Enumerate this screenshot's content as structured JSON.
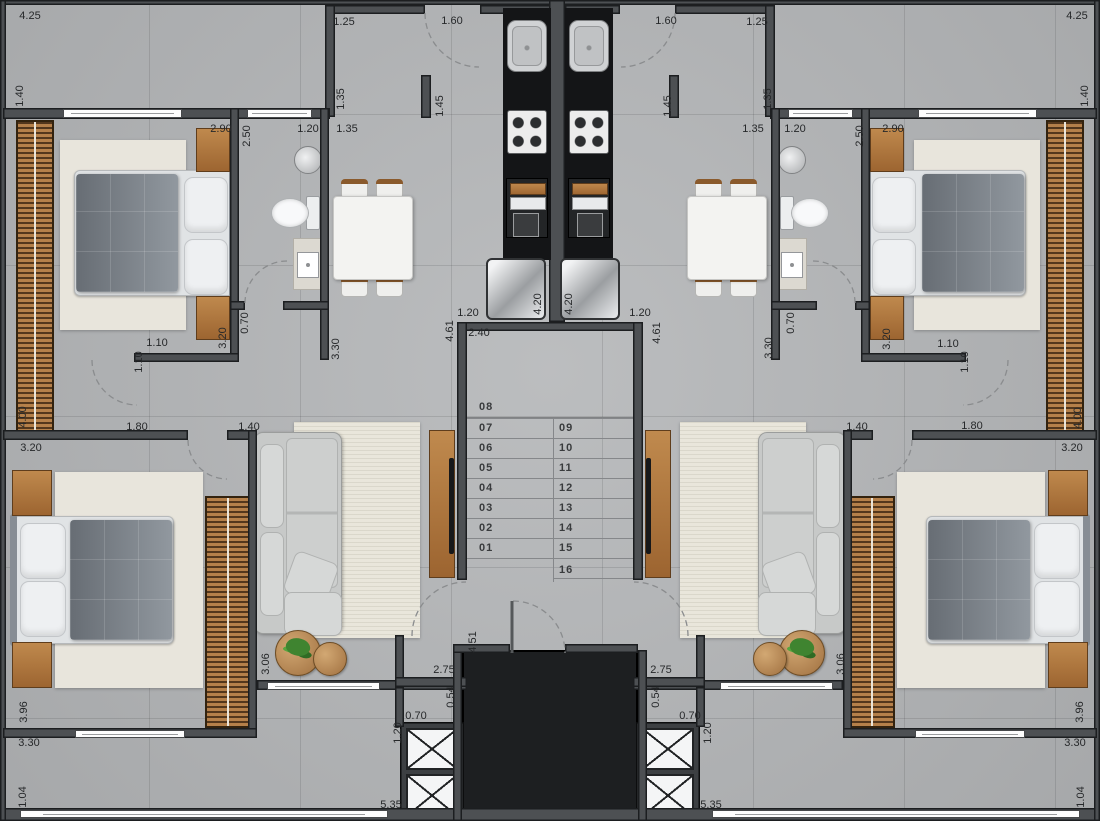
{
  "plan": {
    "type": "residential floor plan - typical storey, two mirrored apartments around central stair and elevator core",
    "stairs": {
      "left_flight": [
        "01",
        "02",
        "03",
        "04",
        "05",
        "06",
        "07",
        "08"
      ],
      "right_flight": [
        "09",
        "10",
        "11",
        "12",
        "13",
        "14",
        "15",
        "16"
      ]
    }
  },
  "colors": {
    "floor": "#b4b6b8",
    "wall": "#4d5053",
    "wallline": "#1c1e20",
    "counter": "#141517",
    "voidfill": "#1d1f21",
    "wood": "#b5804a",
    "woodd": "#8a5a2c",
    "label": "#26282a",
    "windowc": "#fdfdfd",
    "green": "#3f8430"
  },
  "dimension_labels": [
    {
      "t": "4.25",
      "x": 30,
      "y": 16,
      "o": "h"
    },
    {
      "t": "1.40",
      "x": 20,
      "y": 96,
      "o": "v"
    },
    {
      "t": "1.25",
      "x": 344,
      "y": 22,
      "o": "h"
    },
    {
      "t": "1.60",
      "x": 452,
      "y": 21,
      "o": "h"
    },
    {
      "t": "1.60",
      "x": 666,
      "y": 21,
      "o": "h"
    },
    {
      "t": "1.25",
      "x": 757,
      "y": 22,
      "o": "h"
    },
    {
      "t": "4.25",
      "x": 1077,
      "y": 16,
      "o": "h"
    },
    {
      "t": "1.40",
      "x": 1085,
      "y": 96,
      "o": "v"
    },
    {
      "t": "1.35",
      "x": 341,
      "y": 99,
      "o": "v"
    },
    {
      "t": "1.45",
      "x": 440,
      "y": 106,
      "o": "v"
    },
    {
      "t": "1.45",
      "x": 668,
      "y": 106,
      "o": "v"
    },
    {
      "t": "1.35",
      "x": 768,
      "y": 99,
      "o": "v"
    },
    {
      "t": "2.90",
      "x": 221,
      "y": 129,
      "o": "h"
    },
    {
      "t": "2.50",
      "x": 247,
      "y": 136,
      "o": "v"
    },
    {
      "t": "1.20",
      "x": 308,
      "y": 129,
      "o": "h"
    },
    {
      "t": "1.35",
      "x": 347,
      "y": 129,
      "o": "h"
    },
    {
      "t": "1.35",
      "x": 753,
      "y": 129,
      "o": "h"
    },
    {
      "t": "1.20",
      "x": 795,
      "y": 129,
      "o": "h"
    },
    {
      "t": "2.50",
      "x": 860,
      "y": 136,
      "o": "v"
    },
    {
      "t": "2.90",
      "x": 893,
      "y": 129,
      "o": "h"
    },
    {
      "t": "0.70",
      "x": 245,
      "y": 323,
      "o": "v"
    },
    {
      "t": "3.20",
      "x": 223,
      "y": 338,
      "o": "v"
    },
    {
      "t": "3.30",
      "x": 336,
      "y": 349,
      "o": "v"
    },
    {
      "t": "1.10",
      "x": 157,
      "y": 343,
      "o": "h"
    },
    {
      "t": "1.10",
      "x": 139,
      "y": 362,
      "o": "v"
    },
    {
      "t": "0.70",
      "x": 791,
      "y": 323,
      "o": "v"
    },
    {
      "t": "3.20",
      "x": 887,
      "y": 339,
      "o": "v"
    },
    {
      "t": "3.30",
      "x": 769,
      "y": 348,
      "o": "v"
    },
    {
      "t": "1.10",
      "x": 948,
      "y": 344,
      "o": "h"
    },
    {
      "t": "1.10",
      "x": 965,
      "y": 362,
      "o": "v"
    },
    {
      "t": "1.20",
      "x": 468,
      "y": 313,
      "o": "h"
    },
    {
      "t": "4.20",
      "x": 538,
      "y": 304,
      "o": "v"
    },
    {
      "t": "4.20",
      "x": 569,
      "y": 304,
      "o": "v"
    },
    {
      "t": "1.20",
      "x": 640,
      "y": 313,
      "o": "h"
    },
    {
      "t": "4.61",
      "x": 450,
      "y": 331,
      "o": "v"
    },
    {
      "t": "2.40",
      "x": 479,
      "y": 333,
      "o": "h"
    },
    {
      "t": "4.61",
      "x": 657,
      "y": 333,
      "o": "v"
    },
    {
      "t": "1.80",
      "x": 137,
      "y": 427,
      "o": "h"
    },
    {
      "t": "1.40",
      "x": 249,
      "y": 427,
      "o": "h"
    },
    {
      "t": "3.20",
      "x": 31,
      "y": 448,
      "o": "h"
    },
    {
      "t": "4.00",
      "x": 23,
      "y": 417,
      "o": "v"
    },
    {
      "t": "1.80",
      "x": 972,
      "y": 426,
      "o": "h"
    },
    {
      "t": "1.40",
      "x": 857,
      "y": 427,
      "o": "h"
    },
    {
      "t": "3.20",
      "x": 1072,
      "y": 448,
      "o": "h"
    },
    {
      "t": "4.00",
      "x": 1078,
      "y": 418,
      "o": "v"
    },
    {
      "t": "3.06",
      "x": 266,
      "y": 664,
      "o": "v"
    },
    {
      "t": "4.51",
      "x": 473,
      "y": 642,
      "o": "v"
    },
    {
      "t": "2.75",
      "x": 444,
      "y": 670,
      "o": "h"
    },
    {
      "t": "2.75",
      "x": 661,
      "y": 670,
      "o": "h"
    },
    {
      "t": "3.06",
      "x": 841,
      "y": 664,
      "o": "v"
    },
    {
      "t": "0.54",
      "x": 451,
      "y": 697,
      "o": "v"
    },
    {
      "t": "0.54",
      "x": 656,
      "y": 697,
      "o": "v"
    },
    {
      "t": "0.70",
      "x": 416,
      "y": 716,
      "o": "h"
    },
    {
      "t": "0.70",
      "x": 690,
      "y": 716,
      "o": "h"
    },
    {
      "t": "1.20",
      "x": 398,
      "y": 733,
      "o": "v"
    },
    {
      "t": "1.20",
      "x": 708,
      "y": 733,
      "o": "v"
    },
    {
      "t": "5.35",
      "x": 391,
      "y": 805,
      "o": "h"
    },
    {
      "t": "5.35",
      "x": 711,
      "y": 805,
      "o": "h"
    },
    {
      "t": "3.96",
      "x": 24,
      "y": 712,
      "o": "v"
    },
    {
      "t": "3.30",
      "x": 29,
      "y": 743,
      "o": "h"
    },
    {
      "t": "1.04",
      "x": 23,
      "y": 797,
      "o": "v"
    },
    {
      "t": "3.96",
      "x": 1080,
      "y": 712,
      "o": "v"
    },
    {
      "t": "3.30",
      "x": 1075,
      "y": 743,
      "o": "h"
    },
    {
      "t": "1.04",
      "x": 1081,
      "y": 797,
      "o": "v"
    }
  ],
  "step_labels": [
    {
      "t": "08",
      "x": 479,
      "y": 407
    },
    {
      "t": "07",
      "x": 479,
      "y": 428
    },
    {
      "t": "06",
      "x": 479,
      "y": 448
    },
    {
      "t": "05",
      "x": 479,
      "y": 468
    },
    {
      "t": "04",
      "x": 479,
      "y": 488
    },
    {
      "t": "03",
      "x": 479,
      "y": 508
    },
    {
      "t": "02",
      "x": 479,
      "y": 528
    },
    {
      "t": "01",
      "x": 479,
      "y": 548
    },
    {
      "t": "09",
      "x": 559,
      "y": 428
    },
    {
      "t": "10",
      "x": 559,
      "y": 448
    },
    {
      "t": "11",
      "x": 559,
      "y": 468
    },
    {
      "t": "12",
      "x": 559,
      "y": 488
    },
    {
      "t": "13",
      "x": 559,
      "y": 508
    },
    {
      "t": "14",
      "x": 559,
      "y": 528
    },
    {
      "t": "15",
      "x": 559,
      "y": 548
    },
    {
      "t": "16",
      "x": 559,
      "y": 570
    }
  ]
}
